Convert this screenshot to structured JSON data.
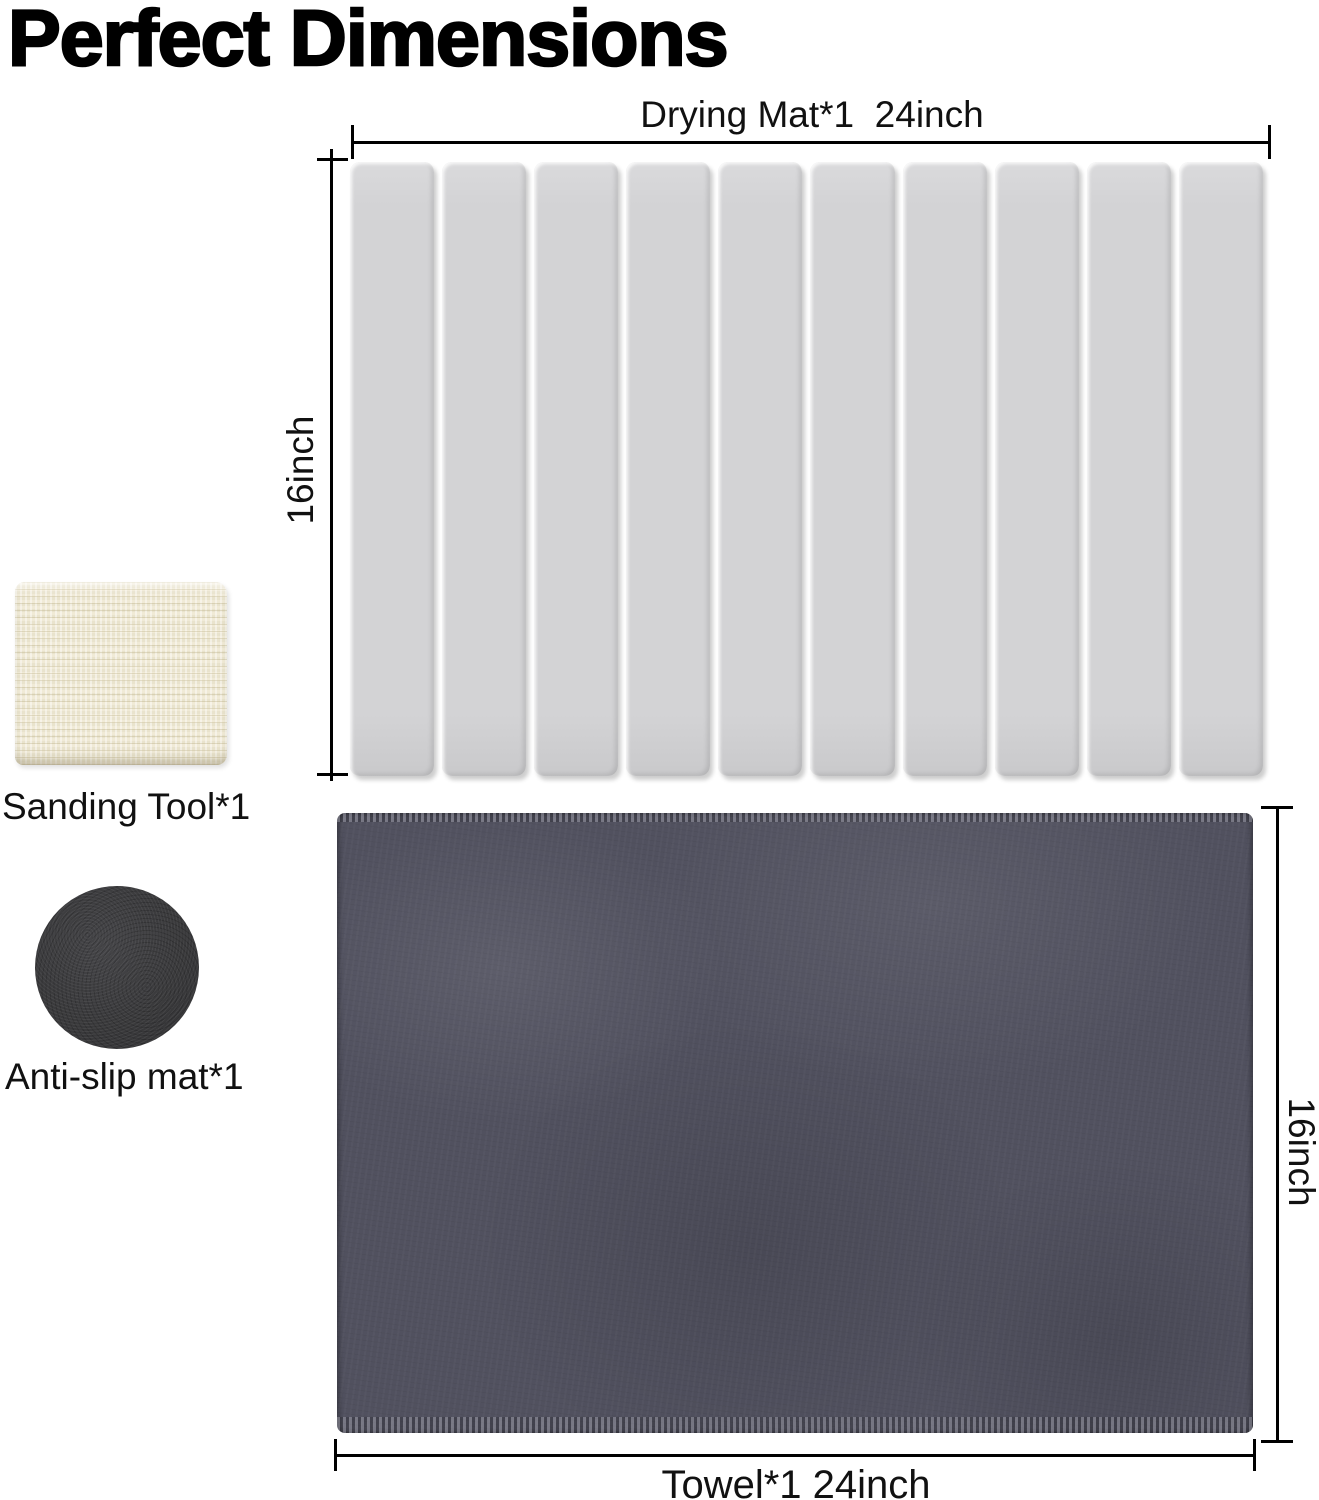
{
  "title": "Perfect Dimensions",
  "drying_mat": {
    "width_label": "Drying Mat*1  24inch",
    "height_label": "16inch",
    "slat_count": 10
  },
  "sanding_tool": {
    "label": "Sanding Tool*1"
  },
  "anti_slip_mat": {
    "label": "Anti-slip mat*1"
  },
  "towel": {
    "width_label": "Towel*1 24inch",
    "height_label": "16inch"
  },
  "colors": {
    "slat-color": "#d3d3d5",
    "towel-color": "#51515f",
    "sanding-color": "#e9e3cd",
    "antislip-color": "#3a3a3c",
    "line-color": "#000000"
  }
}
